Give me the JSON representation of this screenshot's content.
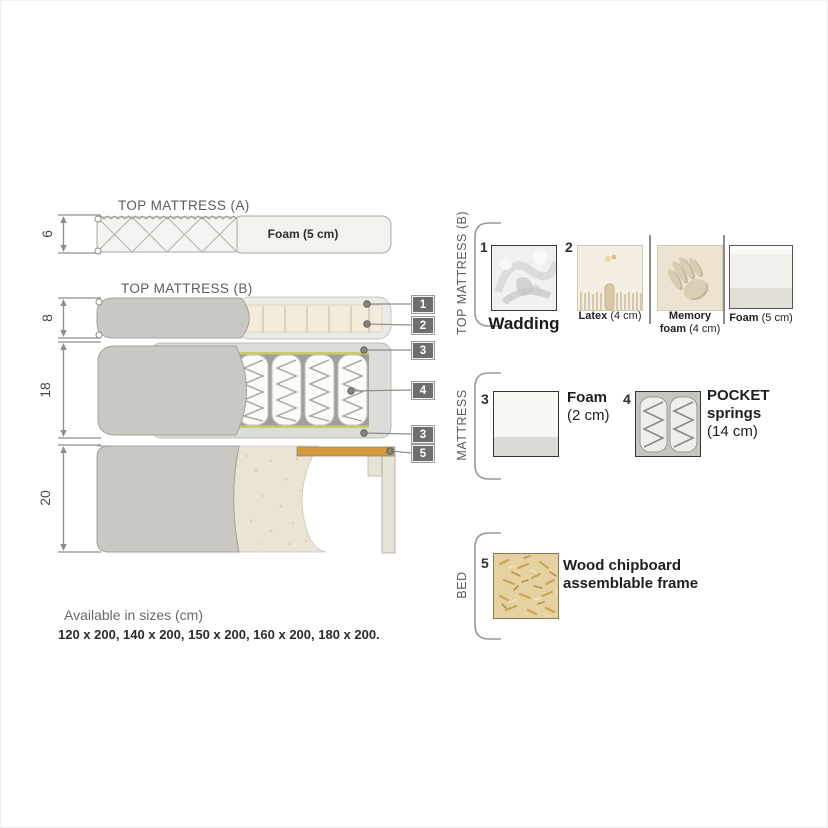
{
  "diagram": {
    "sections": {
      "top_a": {
        "title": "TOP MATTRESS (A)",
        "height_cm": "6",
        "foam_label": "Foam (5 cm)"
      },
      "top_b": {
        "title": "TOP MATTRESS (B)",
        "height_cm": "8"
      },
      "mattress": {
        "height_cm": "18"
      },
      "bed": {
        "height_cm": "20"
      }
    },
    "callouts": [
      "1",
      "2",
      "3",
      "4",
      "3",
      "5"
    ]
  },
  "legend": {
    "groups": [
      {
        "label": "TOP MATTRESS (B)",
        "items": [
          {
            "num": "1",
            "name": "Wadding",
            "image": "wadding-texture"
          },
          {
            "num": "2",
            "options": [
              {
                "name": "Latex",
                "size": "(4 cm)",
                "image": "latex-texture"
              },
              {
                "name": "Memory foam",
                "size": "(4 cm)",
                "image": "memory-foam-handprint"
              },
              {
                "name": "Foam",
                "size": "(5 cm)",
                "image": "foam-block"
              }
            ]
          }
        ]
      },
      {
        "label": "MATTRESS",
        "items": [
          {
            "num": "3",
            "name": "Foam",
            "size": "(2 cm)",
            "image": "foam-block"
          },
          {
            "num": "4",
            "name": "POCKET springs",
            "size": "(14 cm)",
            "image": "pocket-springs"
          }
        ]
      },
      {
        "label": "BED",
        "items": [
          {
            "num": "5",
            "name": "Wood chipboard assemblable frame",
            "image": "chipboard-texture"
          }
        ]
      }
    ]
  },
  "footer": {
    "title": "Available in sizes (cm)",
    "sizes": "120 x 200, 140 x 200, 150 x 200, 160 x 200, 180 x 200."
  },
  "colors": {
    "fabric_grey": "#c9c8c2",
    "foam_cream": "#f4ecdb",
    "wood_orange": "#d5983a",
    "badge_grey": "#6e6e6e",
    "spring_foam_yellow": "#cbcb6b"
  }
}
